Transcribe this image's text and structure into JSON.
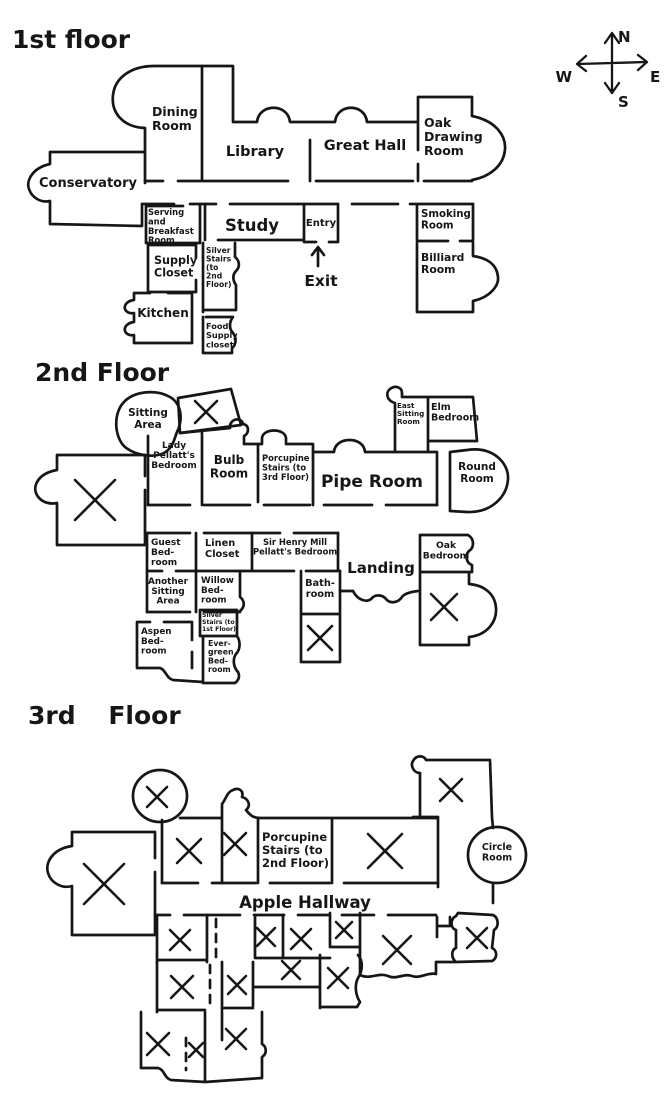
{
  "colors": {
    "ink": "#161616",
    "background": "#ffffff"
  },
  "compass": {
    "north": "N",
    "east": "E",
    "south": "S",
    "west": "W"
  },
  "floor1": {
    "title": "1st floor",
    "rooms": {
      "dining_room": "Dining\nRoom",
      "library": "Library",
      "great_hall": "Great Hall",
      "oak_drawing_room": "Oak\nDrawing\nRoom",
      "conservatory": "Conservatory",
      "serving_breakfast_room": "Serving\nand\nBreakfast\nRoom",
      "study": "Study",
      "entry": "Entry",
      "exit": "Exit",
      "smoking_room": "Smoking\nRoom",
      "supply_closet": "Supply\nCloset",
      "silver_stairs": "Silver\nStairs\n(to\n2nd\nFloor)",
      "billiard_room": "Billiard\nRoom",
      "kitchen": "Kitchen",
      "food_supply_closet": "Food\nSupply\ncloset"
    }
  },
  "floor2": {
    "title": "2nd Floor",
    "rooms": {
      "sitting_area": "Sitting\nArea",
      "lady_pellatts_bedroom": "Lady\nPellatt's\nBedroom",
      "bulb_room": "Bulb\nRoom",
      "porcupine_stairs": "Porcupine\nStairs (to\n3rd Floor)",
      "pipe_room": "Pipe Room",
      "east_sitting_room": "East\nSitting\nRoom",
      "elm_bedroom": "Elm\nBedroom",
      "round_room": "Round\nRoom",
      "guest_bedroom": "Guest\nBed-\nroom",
      "linen_closet": "Linen\nCloset",
      "sir_henry_bedroom": "Sir Henry Mill\nPellatt's Bedroom",
      "landing": "Landing",
      "oak_bedroom": "Oak\nBedroom",
      "another_sitting_area": "Another\nSitting\nArea",
      "willow_bedroom": "Willow\nBed-\nroom",
      "bathroom": "Bath-\nroom",
      "aspen_bedroom": "Aspen\nBed-\nroom",
      "silver_stairs": "Silver\nStairs (to\n1st Floor)",
      "evergreen_bedroom": "Ever-\ngreen\nBed-\nroom"
    }
  },
  "floor3": {
    "title": "3rd Floor",
    "rooms": {
      "porcupine_stairs": "Porcupine\nStairs (to\n2nd Floor)",
      "apple_hallway": "Apple Hallway",
      "circle_room": "Circle\nRoom"
    }
  }
}
